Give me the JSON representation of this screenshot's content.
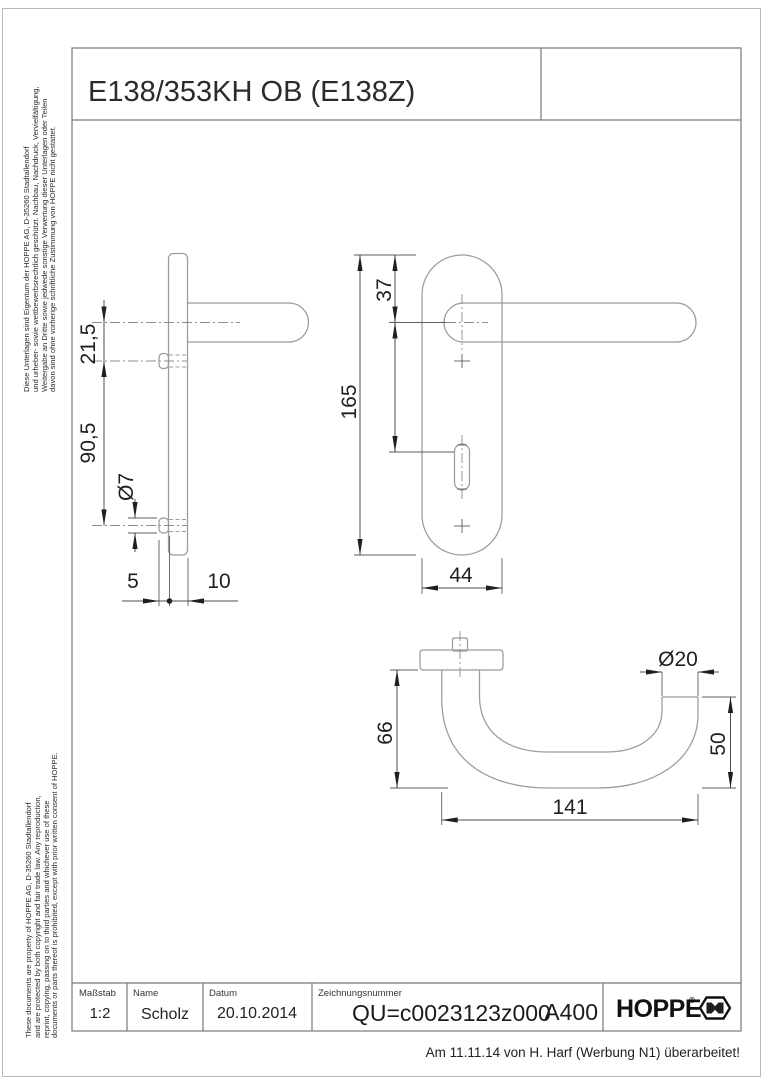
{
  "page": {
    "title": "E138/353KH OB (E138Z)",
    "revision_note": "Am 11.11.14 von H. Harf (Werbung N1) überarbeitet!"
  },
  "side_notes": {
    "german_lines": [
      "Diese Unterlagen sind Eigentum der  HOPPE AG, D-35260 Stadtallendorf",
      "und urheber- sowie wettbewerbsrechtlich geschützt. Nachbau, Nachdruck, Vervielfältigung,",
      "Weitergabe an Dritte sowie jedwede sonstige Verwertung dieser Unterlagen oder Teilen",
      "davon sind ohne vorherige schriftliche Zustimmung von HOPPE nicht gestattet."
    ],
    "english_lines": [
      "These documents are property of  HOPPE AG, D-35260 Stadtallendorf",
      "and are protected by both copyright and fair trade law. Any reproduction,",
      "reprint, copying, passing on to third parties and whichever use of these",
      "documents or parts thereof is prohibited, except with prior written consent of  HOPPE."
    ]
  },
  "dimensions": {
    "side_view": {
      "offset_top": "21,5",
      "hole_spacing": "90,5",
      "hole_dia": "Ø7",
      "boss_depth": "5",
      "plate_depth": "10"
    },
    "front_view": {
      "top_to_center": "37",
      "plate_height": "165",
      "plate_width": "44"
    },
    "top_view": {
      "depth": "66",
      "length": "141",
      "grip_dia": "Ø20",
      "grip_depth": "50"
    }
  },
  "title_block": {
    "scale_label": "Maßstab",
    "scale_value": "1:2",
    "name_label": "Name",
    "name_value": "Scholz",
    "date_label": "Datum",
    "date_value": "20.10.2014",
    "drawing_number_label": "Zeichnungsnummer",
    "drawing_number_value": "QU=c0023123z000",
    "format_code": "A400",
    "brand": "HOPPE",
    "brand_mark": "®"
  },
  "colors": {
    "geometry_line": "#9b9b9b",
    "dimension_line": "#4d4d4d",
    "text": "#1f1f1f",
    "frame": "#777777",
    "background": "#ffffff"
  }
}
